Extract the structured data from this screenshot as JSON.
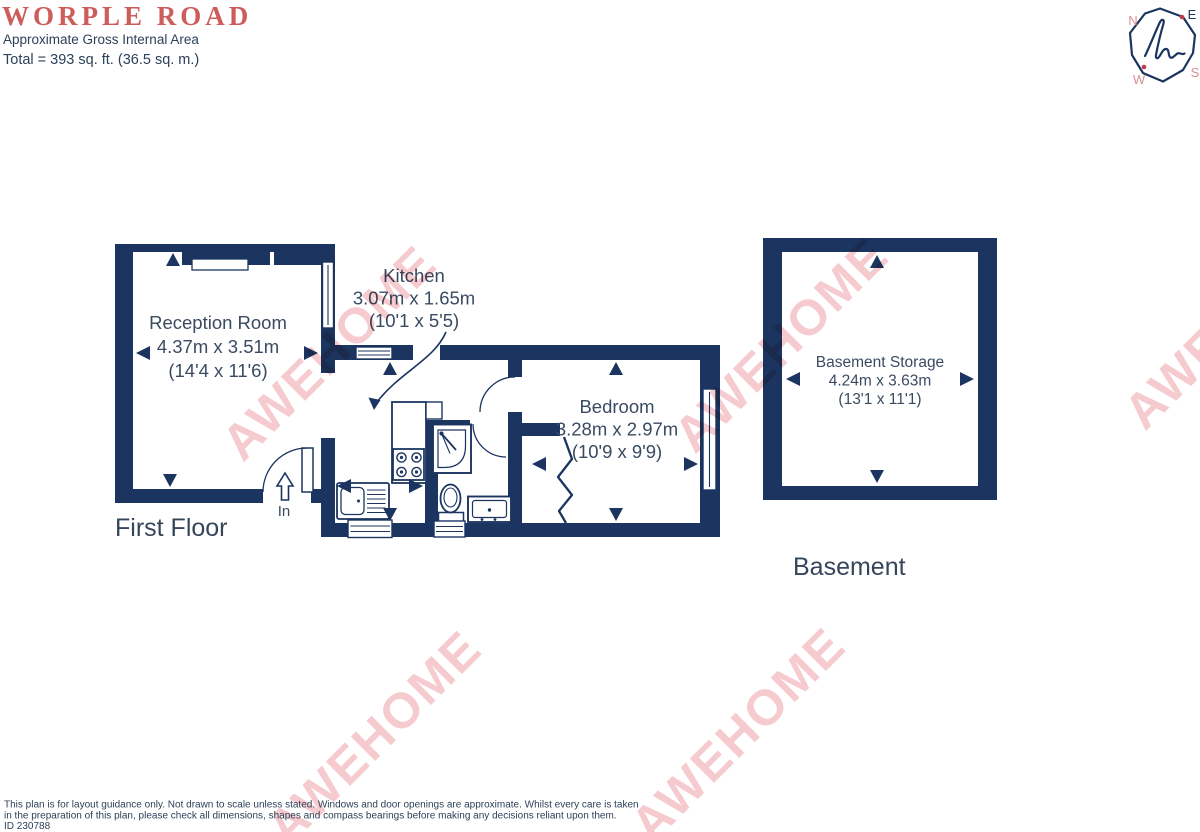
{
  "header": {
    "title": "WORPLE ROAD",
    "subtitle": "Approximate Gross Internal Area",
    "total": "Total = 393 sq. ft. (36.5 sq. m.)"
  },
  "compass": {
    "n": "N",
    "e": "E",
    "s": "S",
    "w": "W"
  },
  "rooms": {
    "reception": {
      "name": "Reception Room",
      "metric": "4.37m x 3.51m",
      "imperial": "(14'4 x 11'6)"
    },
    "kitchen": {
      "name": "Kitchen",
      "metric": "3.07m x 1.65m",
      "imperial": "(10'1 x 5'5)"
    },
    "bedroom": {
      "name": "Bedroom",
      "metric": "3.28m x 2.97m",
      "imperial": "(10'9 x 9'9)"
    },
    "basement_storage": {
      "name": "Basement Storage",
      "metric": "4.24m x 3.63m",
      "imperial": "(13'1 x 11'1)"
    }
  },
  "floors": {
    "first": {
      "label": "First Floor",
      "entrance_label": "In"
    },
    "basement": {
      "label": "Basement"
    }
  },
  "watermark": {
    "text": "AWEHOME"
  },
  "footer": {
    "disclaimer_line1": "This plan is for layout guidance only. Not drawn to scale unless stated. Windows and door openings are approximate. Whilst every care is taken",
    "disclaimer_line2": "in the preparation of this plan, please check all dimensions, shapes and compass bearings before making any decisions reliant upon them.",
    "id": "ID 230788"
  },
  "colors": {
    "navy": "#1b3560",
    "room_text": "#3a4b61",
    "floor_text": "#35465a",
    "text_navy": "#2d4158",
    "title_red": "#ce5c5a",
    "watermark_pink": "#ee97a0",
    "compass_pink": "#d98e92",
    "dot_red": "#c23a50"
  }
}
